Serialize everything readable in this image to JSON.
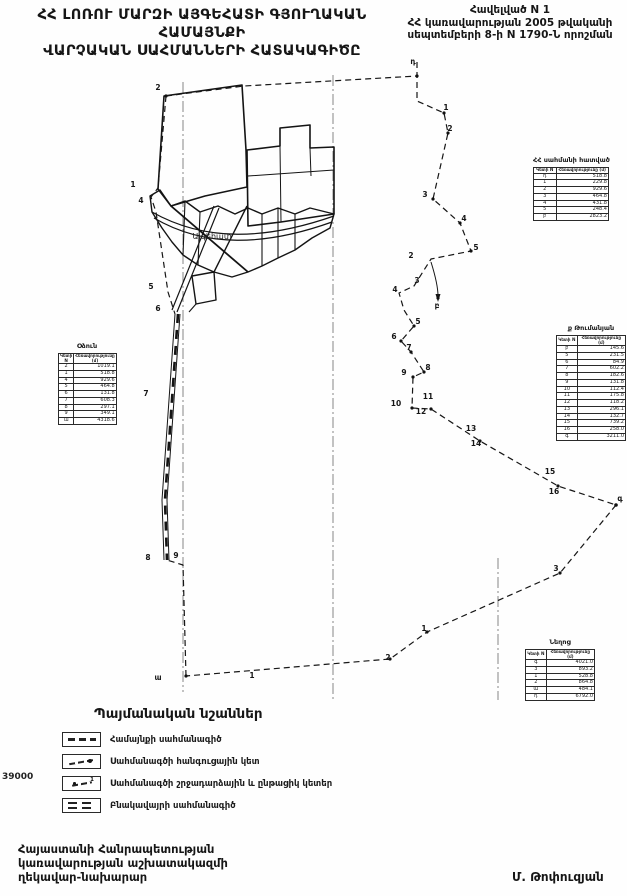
{
  "header": {
    "title_line1": "ՀՀ ԼՈՌՈՒ ՄԱՐԶԻ ԱՅԳԵՀԱՏԻ ԳՅՈՒՂԱԿԱՆ ՀԱՄԱՅՆՔԻ",
    "title_line2": "ՎԱՐՉԱԿԱՆ ՍԱՀՄԱՆՆԵՐԻ ՀԱՏԱԿԱԳԻԾԸ",
    "appendix_line1": "Հավելված N 1",
    "appendix_line2": "ՀՀ կառավարության 2005 թվականի",
    "appendix_line3": "սեպտեմբերի 8-ի  N 1790-Ն որոշման"
  },
  "map": {
    "settlement_label": "Այգեհատ",
    "scale_note": "39000",
    "ink_color": "#1a1a1a",
    "point_labels": [
      {
        "t": "2",
        "x": 158,
        "y": 88
      },
      {
        "t": "1",
        "x": 133,
        "y": 185
      },
      {
        "t": "4",
        "x": 141,
        "y": 201
      },
      {
        "t": "5",
        "x": 151,
        "y": 287
      },
      {
        "t": "6",
        "x": 158,
        "y": 309
      },
      {
        "t": "7",
        "x": 146,
        "y": 394
      },
      {
        "t": "8",
        "x": 148,
        "y": 558
      },
      {
        "t": "9",
        "x": 176,
        "y": 556
      },
      {
        "t": "ա",
        "x": 158,
        "y": 678
      },
      {
        "t": "1",
        "x": 252,
        "y": 676
      },
      {
        "t": "դ",
        "x": 413,
        "y": 62
      },
      {
        "t": "1",
        "x": 446,
        "y": 108
      },
      {
        "t": "2",
        "x": 450,
        "y": 129
      },
      {
        "t": "3",
        "x": 425,
        "y": 195
      },
      {
        "t": "4",
        "x": 464,
        "y": 219
      },
      {
        "t": "5",
        "x": 476,
        "y": 248
      },
      {
        "t": "2",
        "x": 411,
        "y": 256
      },
      {
        "t": "3",
        "x": 417,
        "y": 281
      },
      {
        "t": "4",
        "x": 395,
        "y": 290
      },
      {
        "t": "բ",
        "x": 437,
        "y": 306
      },
      {
        "t": "5",
        "x": 418,
        "y": 322
      },
      {
        "t": "6",
        "x": 394,
        "y": 337
      },
      {
        "t": "7",
        "x": 409,
        "y": 348
      },
      {
        "t": "8",
        "x": 428,
        "y": 368
      },
      {
        "t": "9",
        "x": 404,
        "y": 373
      },
      {
        "t": "10",
        "x": 396,
        "y": 404
      },
      {
        "t": "11",
        "x": 428,
        "y": 397
      },
      {
        "t": "12",
        "x": 421,
        "y": 412
      },
      {
        "t": "13",
        "x": 471,
        "y": 429
      },
      {
        "t": "14",
        "x": 476,
        "y": 444
      },
      {
        "t": "15",
        "x": 550,
        "y": 472
      },
      {
        "t": "16",
        "x": 554,
        "y": 492
      },
      {
        "t": "գ",
        "x": 620,
        "y": 499
      },
      {
        "t": "3",
        "x": 556,
        "y": 569
      },
      {
        "t": "1",
        "x": 424,
        "y": 629
      },
      {
        "t": "2",
        "x": 388,
        "y": 658
      }
    ]
  },
  "tables": [
    {
      "title": "ՀՀ սահմանի հատված",
      "col1": "Կետի N",
      "col2": "Հեռավորությունը (մ)",
      "rows": [
        [
          "դ",
          "518.8"
        ],
        [
          "1",
          "229.8"
        ],
        [
          "2",
          "929.6"
        ],
        [
          "3",
          "464.8"
        ],
        [
          "4",
          "431.8"
        ],
        [
          "5",
          "248.4"
        ],
        [
          "բ",
          "2823.2"
        ]
      ]
    },
    {
      "title": "ք Թումանյան",
      "col1": "Կետի N",
      "col2": "Հեռավորությունը (մ)",
      "rows": [
        [
          "բ",
          "145.6"
        ],
        [
          "5",
          "231.5"
        ],
        [
          "6",
          "84.9"
        ],
        [
          "7",
          "602.2"
        ],
        [
          "8",
          "182.6"
        ],
        [
          "9",
          "131.8"
        ],
        [
          "10",
          "112.4"
        ],
        [
          "11",
          "175.8"
        ],
        [
          "12",
          "118.2"
        ],
        [
          "13",
          "296.1"
        ],
        [
          "14",
          "132.7"
        ],
        [
          "15",
          "739.2"
        ],
        [
          "16",
          "258.0"
        ],
        [
          "գ",
          "3211.0"
        ]
      ]
    },
    {
      "title": "Օձուն",
      "col1": "Կետի N",
      "col2": "Հեռավորությունը (մ)",
      "rows": [
        [
          "2",
          "1019.1"
        ],
        [
          "1",
          "518.8"
        ],
        [
          "4",
          "929.6"
        ],
        [
          "5",
          "464.8"
        ],
        [
          "6",
          "131.8"
        ],
        [
          "7",
          "608.3"
        ],
        [
          "8",
          "297.1"
        ],
        [
          "9",
          "349.1"
        ],
        [
          "ա",
          "4318.6"
        ]
      ]
    },
    {
      "title": "Նեղոց",
      "col1": "Կետի N",
      "col2": "Հեռավորությունը (մ)",
      "rows": [
        [
          "գ",
          "4021.0"
        ],
        [
          "3",
          "893.2"
        ],
        [
          "1",
          "528.8"
        ],
        [
          "2",
          "864.8"
        ],
        [
          "ա",
          "484.1"
        ],
        [
          "դ",
          "6792.0"
        ]
      ]
    }
  ],
  "legend": {
    "title": "Պայմանական նշաններ",
    "items": [
      {
        "label": "Համայնքի սահմանագիծ"
      },
      {
        "label": "Սահմանագծի հանգուցային կետ"
      },
      {
        "label": "Սահմանագծի շրջադարձային և ընթացիկ կետեր"
      },
      {
        "label": "Բնակավայրի սահմանագիծ"
      }
    ]
  },
  "footer": {
    "line1": "Հայաստանի Հանրապետության",
    "line2": "կառավարության աշխատակազմի",
    "line3": "ղեկավար-նախարար",
    "signature": "Մ. Թոփուզյան"
  }
}
